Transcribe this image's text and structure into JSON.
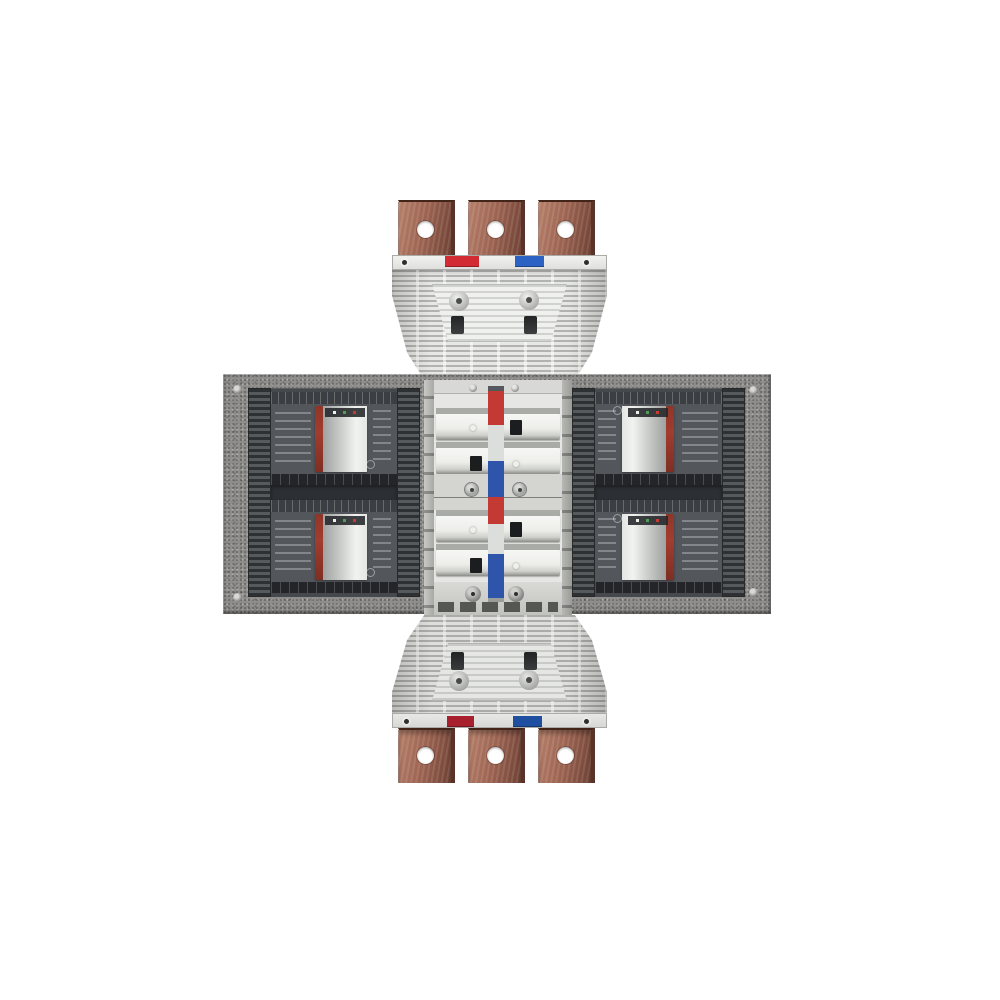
{
  "scene": {
    "kind": "product-render",
    "subject": "three-phase busbar adapter assembly with four molded-case circuit breakers",
    "background": "#ffffff"
  },
  "assembly": {
    "top_terminal_count": 3,
    "bottom_terminal_count": 3,
    "breakers_left": 2,
    "breakers_right": 2,
    "phase_markers_top": [
      "red",
      "blue"
    ],
    "phase_markers_bottom": [
      "red",
      "blue"
    ]
  },
  "phase_stripe": {
    "segments": [
      {
        "name": "cap",
        "color": "#55595d",
        "h": 5
      },
      {
        "name": "red",
        "color": "#c23a33",
        "h": 34
      },
      {
        "name": "white",
        "color": "#dcdedb",
        "h": 36
      },
      {
        "name": "blue",
        "color": "#2e55a9",
        "h": 36
      },
      {
        "name": "red",
        "color": "#c23a33",
        "h": 27
      },
      {
        "name": "white",
        "color": "#dcdedb",
        "h": 30
      },
      {
        "name": "blue",
        "color": "#2e55a9",
        "h": 44
      },
      {
        "name": "end",
        "color": "#9b9d99",
        "h": 4
      }
    ]
  },
  "colors": {
    "background": "#ffffff",
    "copper": "#9c6351",
    "copper_highlight": "#b67f69",
    "copper_shadow": "#6e4134",
    "copper_edge": "#59332a",
    "housing": "#e7e8e5",
    "housing_panel": "#f0f1ee",
    "strip_top": "#f1f2ef",
    "strip_bottom": "#d7d8d5",
    "marker_red_top": "#d32b33",
    "marker_blue_top": "#2b62c4",
    "marker_red_bottom": "#a8202e",
    "marker_blue_bottom": "#1f4fa0",
    "plate": "#8e8d8b",
    "module_body": "#45484c",
    "rib_dark": "#2e3134",
    "rib_light": "#565a5d",
    "module_divider": "#2c2f33",
    "module_band": "#232528",
    "module_face": "#53575c",
    "module_topstrip": "#3b3e42",
    "breaker_red": "#a23c2e",
    "window_light": "#f2f3f0",
    "window_mid": "#c9ccc9",
    "window_dark": "#9fa2a0",
    "column": "#e6e7e4",
    "column_cap": "#d8d9d6",
    "column_groove": "#a9aba7",
    "slot_black": "#1b1d1f",
    "dot_white": "#eef0ec",
    "dot_green": "#4f9e58",
    "dot_red": "#c53a31"
  }
}
